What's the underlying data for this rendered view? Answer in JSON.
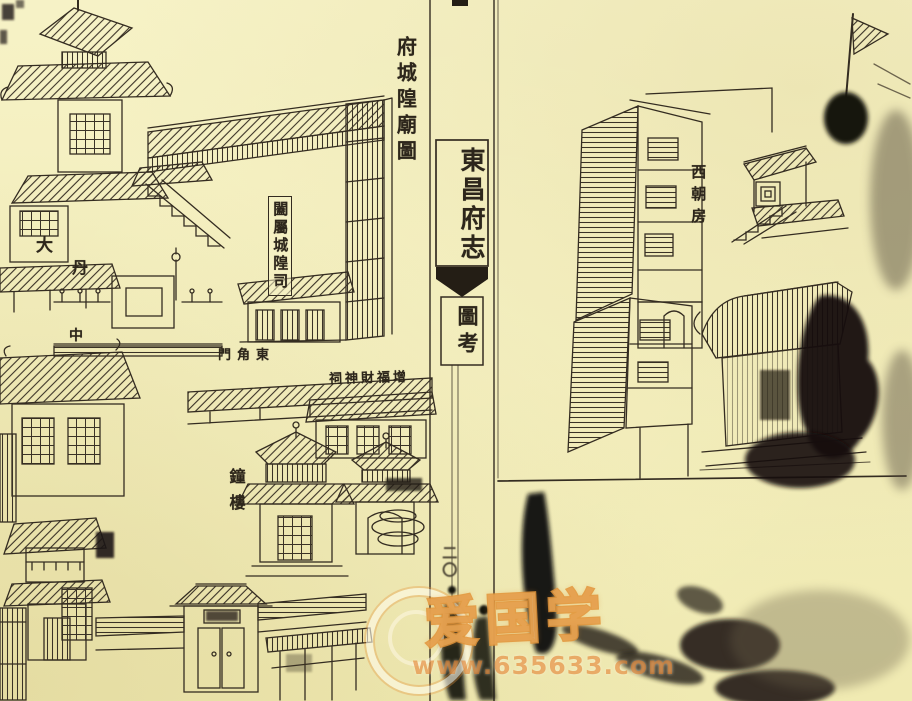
{
  "scan": {
    "paper_color": "#f4efbd",
    "ink_color": "#2f2820"
  },
  "left_page": {
    "title": "府城隍廟圖",
    "labels": {
      "compound_office": "闔屬城隍司",
      "da": "大",
      "dan": "丹",
      "zhong": "中",
      "east_corner_gate": "門角東",
      "wealth_god_shrine": "祠神財福增",
      "bell_tower": "鐘樓"
    }
  },
  "spine": {
    "book_title": "東昌府志",
    "section_title": "圖考",
    "page_number": "二〇"
  },
  "right_page": {
    "labels": {
      "west_chamber": "西朝房"
    }
  },
  "watermark": {
    "logo_text": "爱国学",
    "url_text": "www.635633.com",
    "accent_color": "#e0862c"
  }
}
